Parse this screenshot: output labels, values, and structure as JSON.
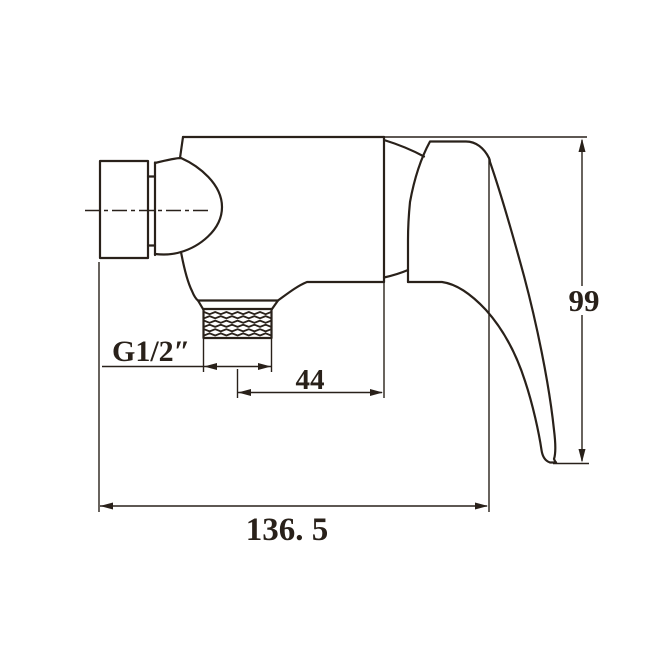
{
  "app": {
    "background": "#ffffff",
    "ink": "#29211a"
  },
  "drawing": {
    "labels": {
      "thread_size": "G1/2″",
      "outlet_offset": "44",
      "height": "99",
      "overall_length": "136. 5"
    }
  }
}
